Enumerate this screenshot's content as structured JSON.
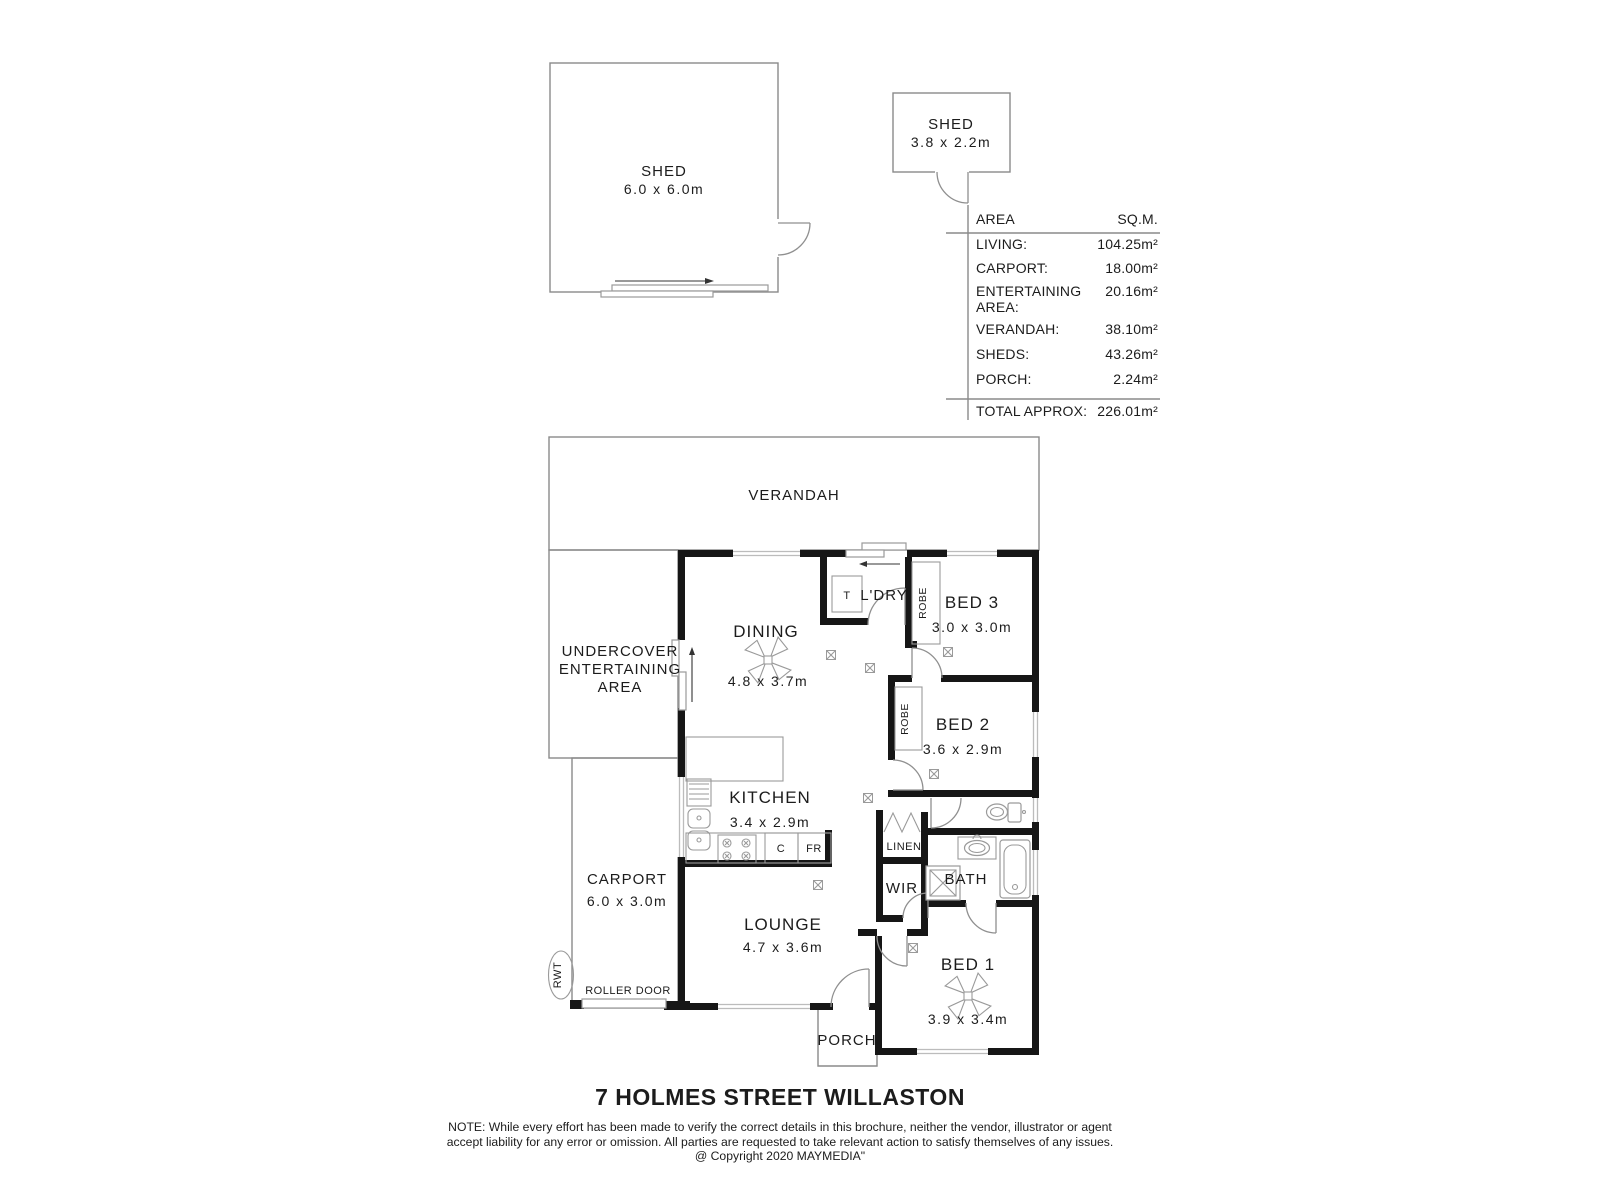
{
  "colors": {
    "wall": "#161616",
    "line": "#8a8a8a",
    "window": "#bcbcbc",
    "text": "#1c1c1c"
  },
  "sheds": {
    "large_label": "SHED",
    "large_dims": "6.0 x 6.0m",
    "small_label": "SHED",
    "small_dims": "3.8 x 2.2m"
  },
  "area_table": {
    "col_area": "AREA",
    "col_sqm": "SQ.M.",
    "rows": [
      {
        "label": "LIVING:",
        "value": "104.25m²"
      },
      {
        "label": "CARPORT:",
        "value": "18.00m²"
      },
      {
        "label": "ENTERTAINING",
        "label2": "AREA:",
        "value": "20.16m²"
      },
      {
        "label": "VERANDAH:",
        "value": "38.10m²"
      },
      {
        "label": "SHEDS:",
        "value": "43.26m²"
      },
      {
        "label": "PORCH:",
        "value": "2.24m²"
      }
    ],
    "total_label": "TOTAL APPROX:",
    "total_value": "226.01m²"
  },
  "rooms": {
    "verandah": "VERANDAH",
    "entertaining1": "UNDERCOVER",
    "entertaining2": "ENTERTAINING",
    "entertaining3": "AREA",
    "carport": "CARPORT",
    "carport_dims": "6.0 x 3.0m",
    "roller_door": "ROLLER DOOR",
    "rwt": "RWT",
    "dining": "DINING",
    "dining_dims": "4.8 x 3.7m",
    "laundry": "L'DRY",
    "trough": "T",
    "bed3": "BED 3",
    "bed3_dims": "3.0 x 3.0m",
    "bed2": "BED 2",
    "bed2_dims": "3.6 x 2.9m",
    "bed1": "BED 1",
    "bed1_dims": "3.9 x 3.4m",
    "robe_bed3": "ROBE",
    "robe_bed2": "ROBE",
    "kitchen": "KITCHEN",
    "kitchen_dims": "3.4 x 2.9m",
    "cupboard": "C",
    "fridge": "FR",
    "lounge": "LOUNGE",
    "lounge_dims": "4.7 x 3.6m",
    "linen": "LINEN",
    "wir": "WIR",
    "bath": "BATH",
    "porch": "PORCH"
  },
  "footer": {
    "title": "7 HOLMES STREET WILLASTON",
    "note1": "NOTE: While every effort has been made to verify the correct details in this brochure, neither the vendor, illustrator or agent",
    "note2": "accept liability for any error or omission. All parties are requested to take relevant action to satisfy themselves of any issues.",
    "copyright": "@ Copyright 2020 MAYMEDIA\""
  }
}
